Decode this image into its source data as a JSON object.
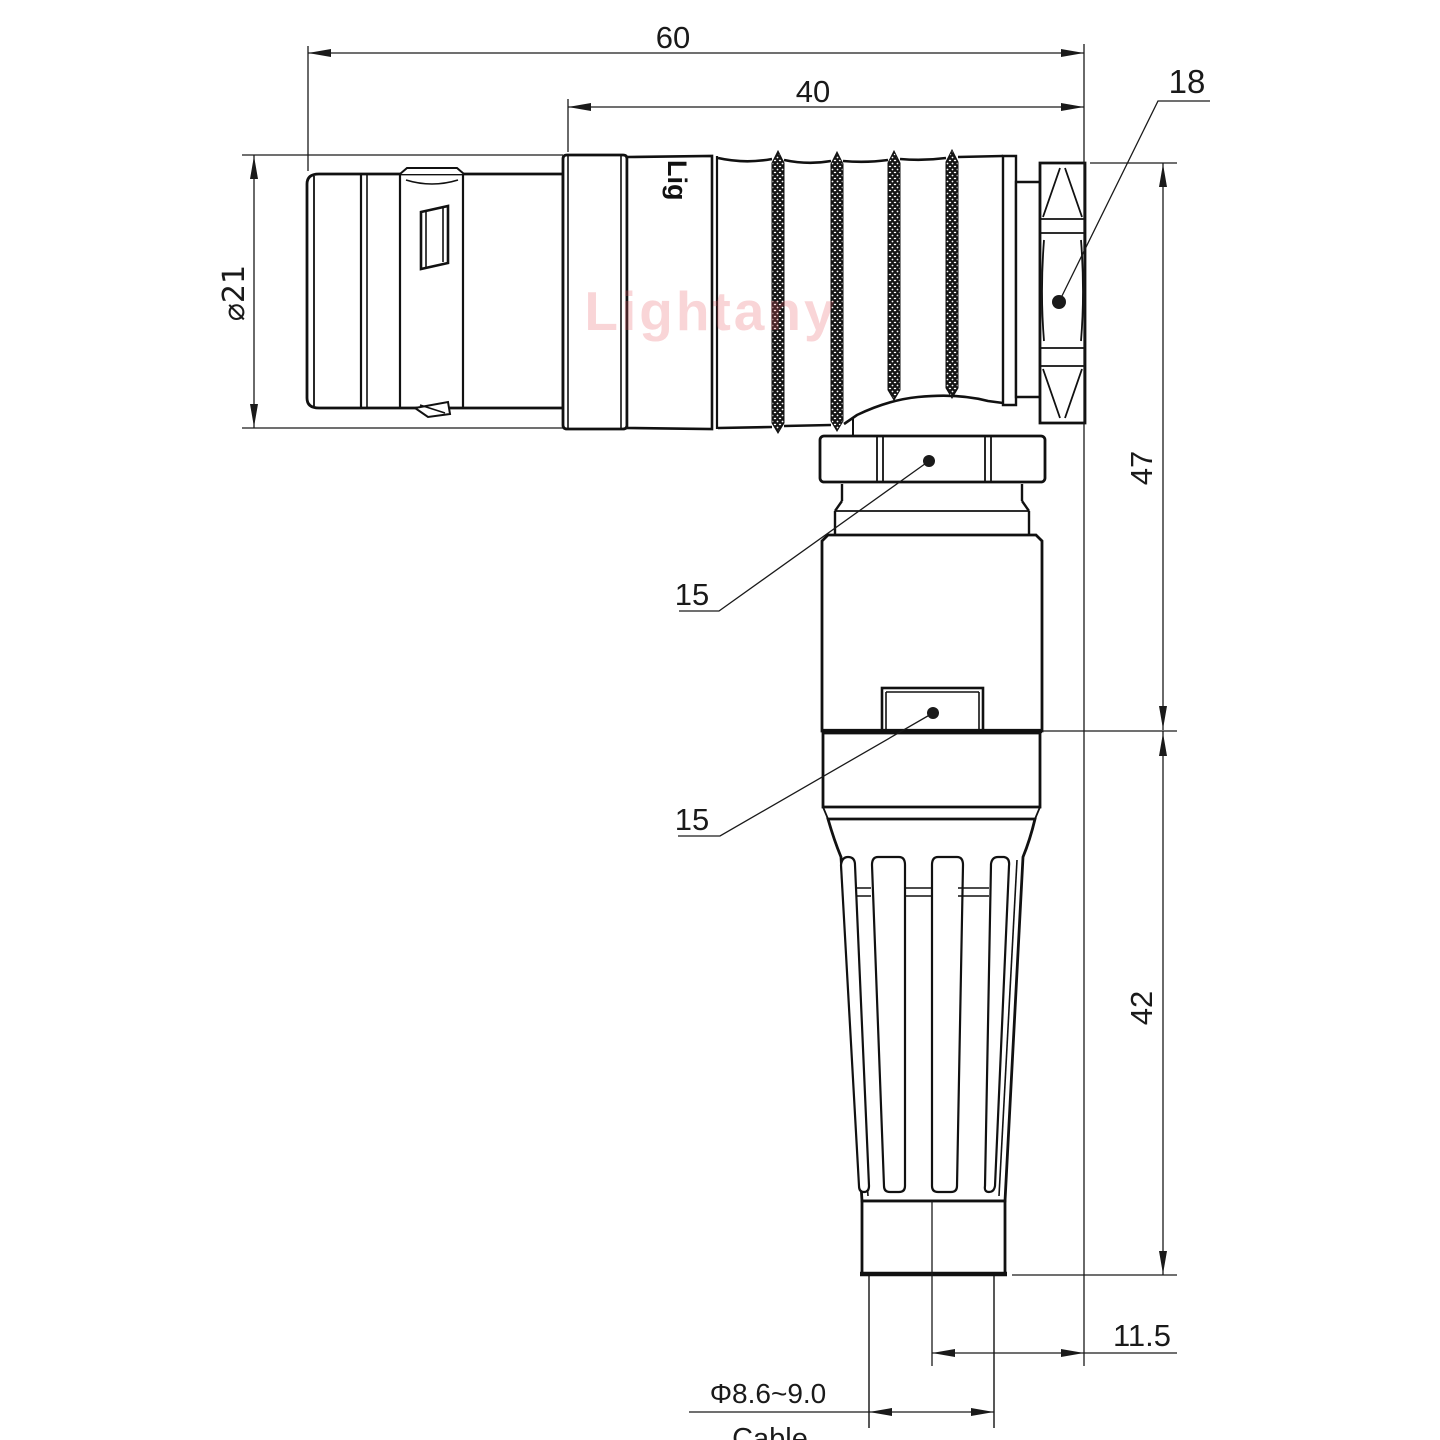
{
  "title": "Right-angle push-pull connector dimensional drawing",
  "watermark": {
    "text": "Lightany",
    "color": "#e85a64"
  },
  "brand_marking": "Lig",
  "labels": {
    "d60": "60",
    "d40": "40",
    "d18": "18",
    "dphi21": "⌀21",
    "d47": "47",
    "d15_upper": "15",
    "d15_lower": "15",
    "d42": "42",
    "d11_5": "11.5",
    "dcable_dia": "Φ8.6~9.0",
    "cable": "Cable"
  },
  "colors": {
    "line": "#111111",
    "background": "#ffffff",
    "watermark": "#e85a64"
  }
}
